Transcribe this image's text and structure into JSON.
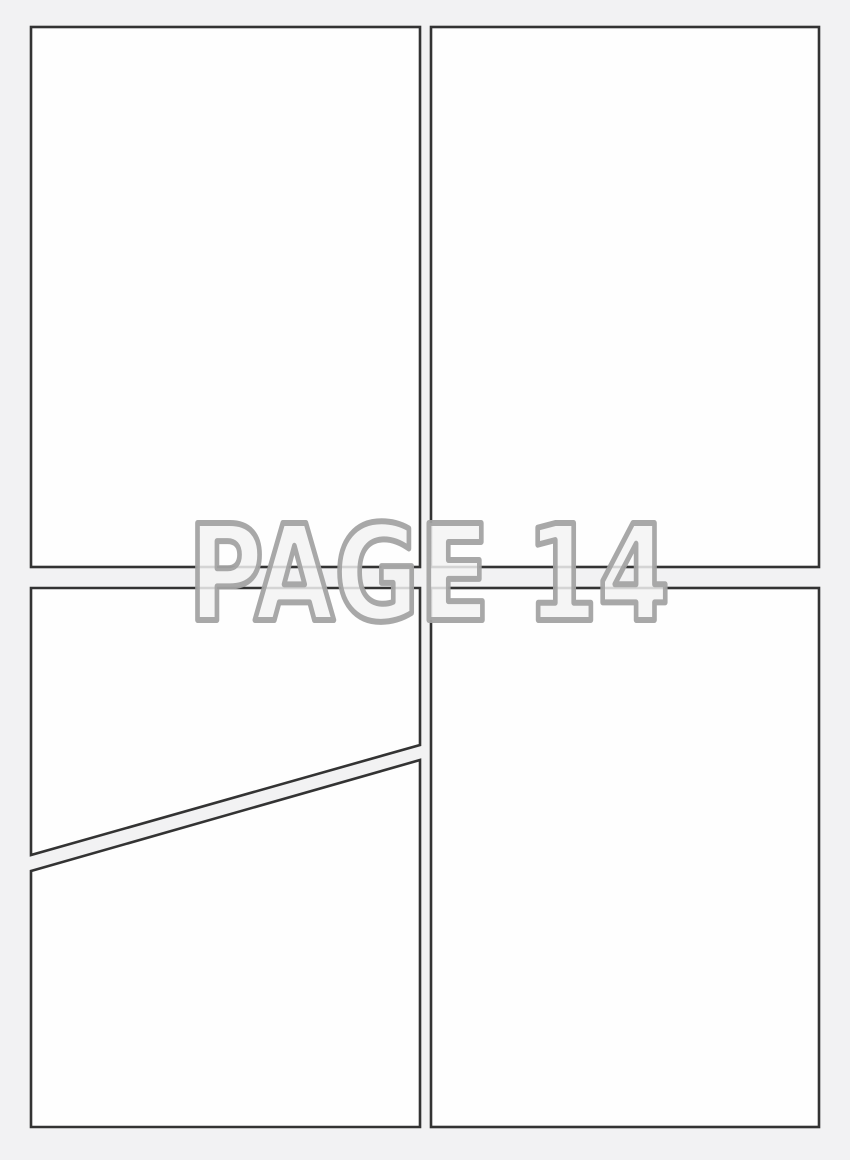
{
  "watermark": {
    "text": "PAGE 14"
  },
  "colors": {
    "background": "#f2f2f3",
    "panel_fill": "#fefefe",
    "panel_border": "#333333",
    "watermark_fill": "#f3f3f3",
    "watermark_stroke": "#a3a3a3"
  },
  "panels": [
    {
      "id": "top-left"
    },
    {
      "id": "top-right"
    },
    {
      "id": "middle-left-diagonal-upper"
    },
    {
      "id": "bottom-left-diagonal-lower"
    },
    {
      "id": "bottom-right"
    }
  ]
}
